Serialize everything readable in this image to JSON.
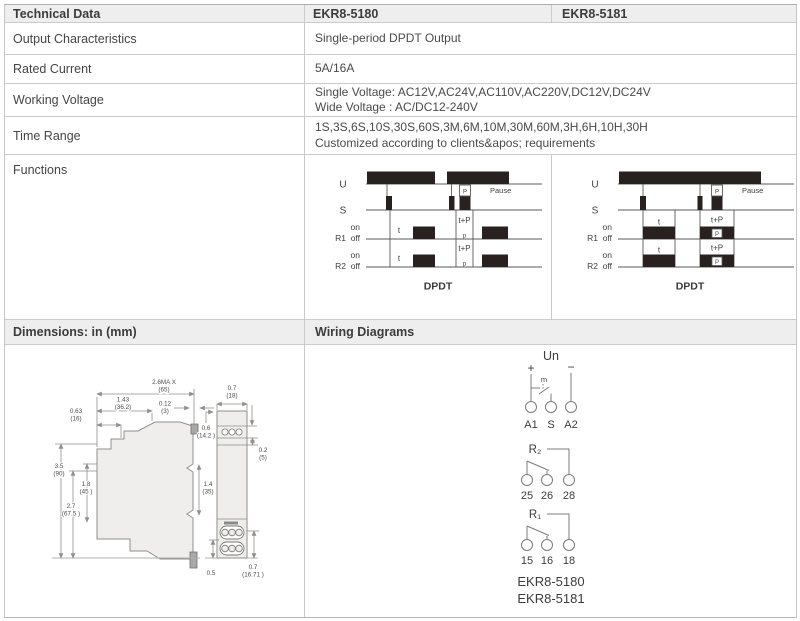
{
  "header": {
    "col1": "Technical Data",
    "col2": "EKR8-5180",
    "col3": "EKR8-5181"
  },
  "specs": [
    {
      "label": "Output Characteristics",
      "lines": [
        "Single-period DPDT Output"
      ]
    },
    {
      "label": "Rated Current",
      "lines": [
        "5A/16A"
      ]
    },
    {
      "label": "Working Voltage",
      "lines": [
        "Single Voltage: AC12V,AC24V,AC110V,AC220V,DC12V,DC24V",
        "Wide Voltage : AC/DC12-240V"
      ]
    },
    {
      "label": "Time Range",
      "lines": [
        "1S,3S,6S,10S,30S,60S,3M,6M,10M,30M,60M,3H,6H,10H,30H",
        "Customized according to clients&apos; requirements"
      ]
    },
    {
      "label": "Functions"
    }
  ],
  "timing": {
    "u": "U",
    "s": "S",
    "r1": "R1",
    "r2": "R2",
    "on": "on",
    "off": "off",
    "t": "t",
    "t_plus_p": "t+P",
    "p_upper": "P",
    "p_lower": "p",
    "pause": "Pause",
    "caption": "DPDT"
  },
  "sections": {
    "dimensions": "Dimensions: in (mm)",
    "wiring": "Wiring Diagrams"
  },
  "dims": {
    "max_in": "2.6MA X",
    "max_mm": "(65)",
    "w143_in": "1.43",
    "w143_mm": "(36.2)",
    "w063_in": "0.63",
    "w063_mm": "(16)",
    "w012_in": "0.12",
    "w012_mm": "(3)",
    "w07_in": "0.7",
    "w07_mm": "(18)",
    "w06_in": "0.6",
    "w06_mm": "(14.2 )",
    "w02_in": "0.2",
    "w02_mm": "(5)",
    "h35_in": "3.5",
    "h35_mm": "(90)",
    "h18_in": "1.8",
    "h18_mm": "(45 )",
    "h27_in": "2.7",
    "h27_mm": "(67.5 )",
    "h14_in": "1.4",
    "h14_mm": "(35)",
    "b05_in": "0.5",
    "b07_in": "0.7",
    "b07_mm": "(16.71 )"
  },
  "wiring": {
    "un": "Un",
    "plus": "+",
    "minus": "−",
    "m": "m",
    "a1": "A1",
    "s": "S",
    "a2": "A2",
    "r2": "R₂",
    "t25": "25",
    "t26": "26",
    "t28": "28",
    "r1": "R₁",
    "t15": "15",
    "t16": "16",
    "t18": "18",
    "model_a": "EKR8-5180",
    "model_b": "EKR8-5181"
  },
  "colors": {
    "band_bg": "#eeeeee",
    "border": "#cbcbcb",
    "bar_fill": "#292120",
    "text": "#4a4a4a"
  }
}
